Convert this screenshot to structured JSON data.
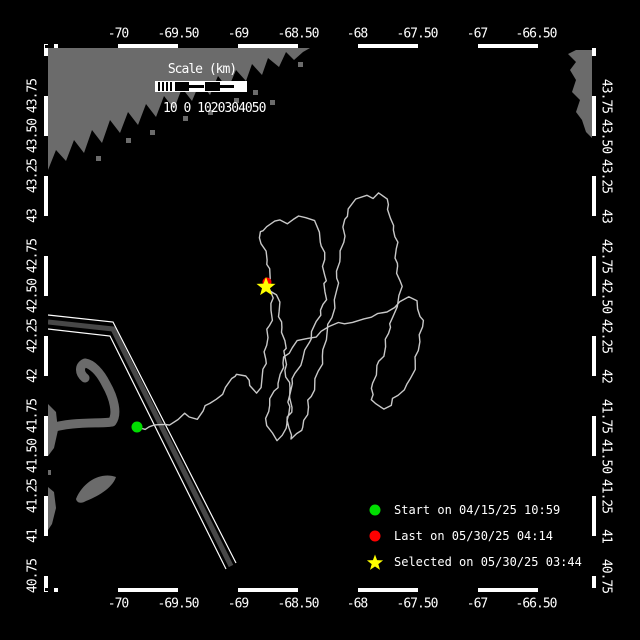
{
  "colors": {
    "background": "#000000",
    "land": "#6b6b6b",
    "track": "#c8c8c8",
    "frame": "#ffffff",
    "lane_core": "#474747",
    "start_marker": "#00dd00",
    "last_marker": "#ff0000",
    "selected_marker": "#ffff00",
    "text": "#ffffff"
  },
  "axes": {
    "lon_labels": [
      {
        "text": "-70",
        "x": 118
      },
      {
        "text": "-69.50",
        "x": 178
      },
      {
        "text": "-69",
        "x": 238
      },
      {
        "text": "-68.50",
        "x": 298
      },
      {
        "text": "-68",
        "x": 357
      },
      {
        "text": "-67.50",
        "x": 417
      },
      {
        "text": "-67",
        "x": 477
      },
      {
        "text": "-66.50",
        "x": 536
      }
    ],
    "lat_labels": [
      {
        "text": "43.75",
        "y": 96
      },
      {
        "text": "43.50",
        "y": 136
      },
      {
        "text": "43.25",
        "y": 176
      },
      {
        "text": "43",
        "y": 216
      },
      {
        "text": "42.75",
        "y": 256
      },
      {
        "text": "42.50",
        "y": 296
      },
      {
        "text": "42.25",
        "y": 336
      },
      {
        "text": "42",
        "y": 376
      },
      {
        "text": "41.75",
        "y": 416
      },
      {
        "text": "41.50",
        "y": 456
      },
      {
        "text": "41.25",
        "y": 496
      },
      {
        "text": "41",
        "y": 536
      },
      {
        "text": "40.75",
        "y": 576
      }
    ],
    "top_label_y": 34,
    "bottom_label_y": 604,
    "left_label_x": 33,
    "right_label_x": 606
  },
  "scale_bar": {
    "title": "Scale (km)",
    "tick_text": "10 0 1020304050"
  },
  "legend": {
    "items": [
      {
        "marker": "start-dot",
        "color": "#00dd00",
        "label": "Start on 04/15/25 10:59"
      },
      {
        "marker": "last-dot",
        "color": "#ff0000",
        "label": "Last on 05/30/25 04:14"
      },
      {
        "marker": "selected-star",
        "color": "#ffff00",
        "label": "Selected on 05/30/25 03:44"
      }
    ]
  },
  "map": {
    "markers": {
      "start": {
        "x": 137,
        "y": 427,
        "r": 5.5
      },
      "last": {
        "x": 267,
        "y": 282,
        "r": 4.5
      },
      "selected": {
        "x": 266,
        "y": 287,
        "R": 10,
        "r": 4.2
      }
    },
    "shipping_lane": {
      "core": [
        [
          48,
          322
        ],
        [
          113,
          329
        ],
        [
          231,
          566
        ]
      ],
      "edge_a": [
        [
          48,
          315
        ],
        [
          113,
          322
        ],
        [
          236,
          563
        ]
      ],
      "edge_b": [
        [
          48,
          329
        ],
        [
          110,
          336
        ],
        [
          226,
          569
        ]
      ]
    },
    "land": {
      "polygons": [
        [
          [
            48,
            48
          ],
          [
            310,
            48
          ],
          [
            303,
            52
          ],
          [
            294,
            60
          ],
          [
            286,
            52
          ],
          [
            279,
            67
          ],
          [
            268,
            58
          ],
          [
            262,
            75
          ],
          [
            252,
            64
          ],
          [
            246,
            81
          ],
          [
            236,
            70
          ],
          [
            228,
            89
          ],
          [
            218,
            76
          ],
          [
            210,
            95
          ],
          [
            200,
            82
          ],
          [
            192,
            101
          ],
          [
            182,
            88
          ],
          [
            174,
            109
          ],
          [
            164,
            96
          ],
          [
            156,
            117
          ],
          [
            146,
            104
          ],
          [
            138,
            125
          ],
          [
            128,
            112
          ],
          [
            120,
            133
          ],
          [
            110,
            120
          ],
          [
            102,
            143
          ],
          [
            92,
            130
          ],
          [
            84,
            153
          ],
          [
            74,
            140
          ],
          [
            66,
            161
          ],
          [
            56,
            150
          ],
          [
            48,
            170
          ]
        ],
        [
          [
            592,
            50
          ],
          [
            592,
            138
          ],
          [
            586,
            132
          ],
          [
            582,
            120
          ],
          [
            576,
            112
          ],
          [
            580,
            100
          ],
          [
            572,
            92
          ],
          [
            576,
            80
          ],
          [
            570,
            70
          ],
          [
            576,
            62
          ],
          [
            568,
            54
          ],
          [
            576,
            50
          ]
        ],
        [
          [
            48,
            404
          ],
          [
            56,
            412
          ],
          [
            58,
            430
          ],
          [
            54,
            448
          ],
          [
            48,
            456
          ]
        ],
        [
          [
            48,
            487
          ],
          [
            54,
            492
          ],
          [
            56,
            508
          ],
          [
            52,
            524
          ],
          [
            48,
            530
          ]
        ]
      ],
      "islets": [
        [
          255,
          92
        ],
        [
          272,
          102
        ],
        [
          236,
          100
        ],
        [
          300,
          64
        ],
        [
          152,
          132
        ],
        [
          185,
          118
        ],
        [
          210,
          112
        ],
        [
          128,
          140
        ],
        [
          98,
          158
        ],
        [
          48,
          472
        ]
      ],
      "fill_paths": [
        "M 76,499 C 84,480 102,472 116,477 C 112,489 96,497 86,501 C 81,504 77,503 76,499 Z"
      ],
      "stroke_paths": [
        {
          "d": "M 48,429 C 72,421 98,424 112,422 C 118,414 114,398 106,384 C 100,372 92,364 85,363 C 79,366 79,373 85,378",
          "w": 9
        }
      ]
    },
    "track": {
      "points": [
        [
          137,
          427
        ],
        [
          149,
          429
        ],
        [
          160,
          423
        ],
        [
          172,
          425
        ],
        [
          184,
          415
        ],
        [
          196,
          417
        ],
        [
          206,
          407
        ],
        [
          216,
          399
        ],
        [
          224,
          393
        ],
        [
          230,
          381
        ],
        [
          237,
          372
        ],
        [
          245,
          376
        ],
        [
          252,
          386
        ],
        [
          258,
          394
        ],
        [
          262,
          378
        ],
        [
          265,
          358
        ],
        [
          268,
          338
        ],
        [
          270,
          318
        ],
        [
          272,
          298
        ],
        [
          270,
          278
        ],
        [
          266,
          258
        ],
        [
          262,
          244
        ],
        [
          260,
          233
        ],
        [
          268,
          225
        ],
        [
          278,
          221
        ],
        [
          288,
          223
        ],
        [
          298,
          215
        ],
        [
          308,
          218
        ],
        [
          316,
          223
        ],
        [
          320,
          240
        ],
        [
          324,
          260
        ],
        [
          326,
          280
        ],
        [
          324,
          298
        ],
        [
          320,
          316
        ],
        [
          314,
          330
        ],
        [
          308,
          344
        ],
        [
          302,
          358
        ],
        [
          296,
          372
        ],
        [
          292,
          386
        ],
        [
          289,
          400
        ],
        [
          287,
          414
        ],
        [
          289,
          428
        ],
        [
          293,
          438
        ],
        [
          298,
          436
        ],
        [
          302,
          426
        ],
        [
          306,
          414
        ],
        [
          310,
          402
        ],
        [
          314,
          388
        ],
        [
          318,
          372
        ],
        [
          322,
          356
        ],
        [
          326,
          340
        ],
        [
          330,
          324
        ],
        [
          333,
          308
        ],
        [
          336,
          292
        ],
        [
          338,
          276
        ],
        [
          340,
          258
        ],
        [
          342,
          242
        ],
        [
          344,
          228
        ],
        [
          347,
          215
        ],
        [
          350,
          207
        ],
        [
          357,
          200
        ],
        [
          365,
          196
        ],
        [
          372,
          199
        ],
        [
          379,
          193
        ],
        [
          386,
          197
        ],
        [
          390,
          212
        ],
        [
          394,
          230
        ],
        [
          396,
          250
        ],
        [
          398,
          268
        ],
        [
          400,
          286
        ],
        [
          398,
          302
        ],
        [
          394,
          316
        ],
        [
          390,
          328
        ],
        [
          386,
          340
        ],
        [
          382,
          354
        ],
        [
          378,
          368
        ],
        [
          374,
          382
        ],
        [
          371,
          394
        ],
        [
          370,
          401
        ],
        [
          376,
          405
        ],
        [
          383,
          407
        ],
        [
          391,
          404
        ],
        [
          399,
          396
        ],
        [
          407,
          384
        ],
        [
          413,
          370
        ],
        [
          417,
          356
        ],
        [
          420,
          342
        ],
        [
          422,
          328
        ],
        [
          420,
          314
        ],
        [
          416,
          303
        ],
        [
          410,
          297
        ],
        [
          402,
          301
        ],
        [
          394,
          307
        ],
        [
          386,
          311
        ],
        [
          378,
          315
        ],
        [
          370,
          319
        ],
        [
          362,
          317
        ],
        [
          354,
          321
        ],
        [
          346,
          325
        ],
        [
          338,
          323
        ],
        [
          330,
          327
        ],
        [
          322,
          331
        ],
        [
          314,
          335
        ],
        [
          306,
          339
        ],
        [
          298,
          343
        ],
        [
          292,
          347
        ],
        [
          286,
          357
        ],
        [
          282,
          369
        ],
        [
          278,
          381
        ],
        [
          274,
          393
        ],
        [
          270,
          405
        ],
        [
          267,
          417
        ],
        [
          266,
          427
        ],
        [
          270,
          435
        ],
        [
          277,
          439
        ],
        [
          283,
          434
        ],
        [
          288,
          424
        ],
        [
          291,
          412
        ],
        [
          290,
          398
        ],
        [
          288,
          382
        ],
        [
          286,
          364
        ],
        [
          284,
          346
        ],
        [
          282,
          328
        ],
        [
          280,
          310
        ],
        [
          276,
          297
        ],
        [
          271,
          290
        ],
        [
          267,
          286
        ]
      ]
    }
  }
}
